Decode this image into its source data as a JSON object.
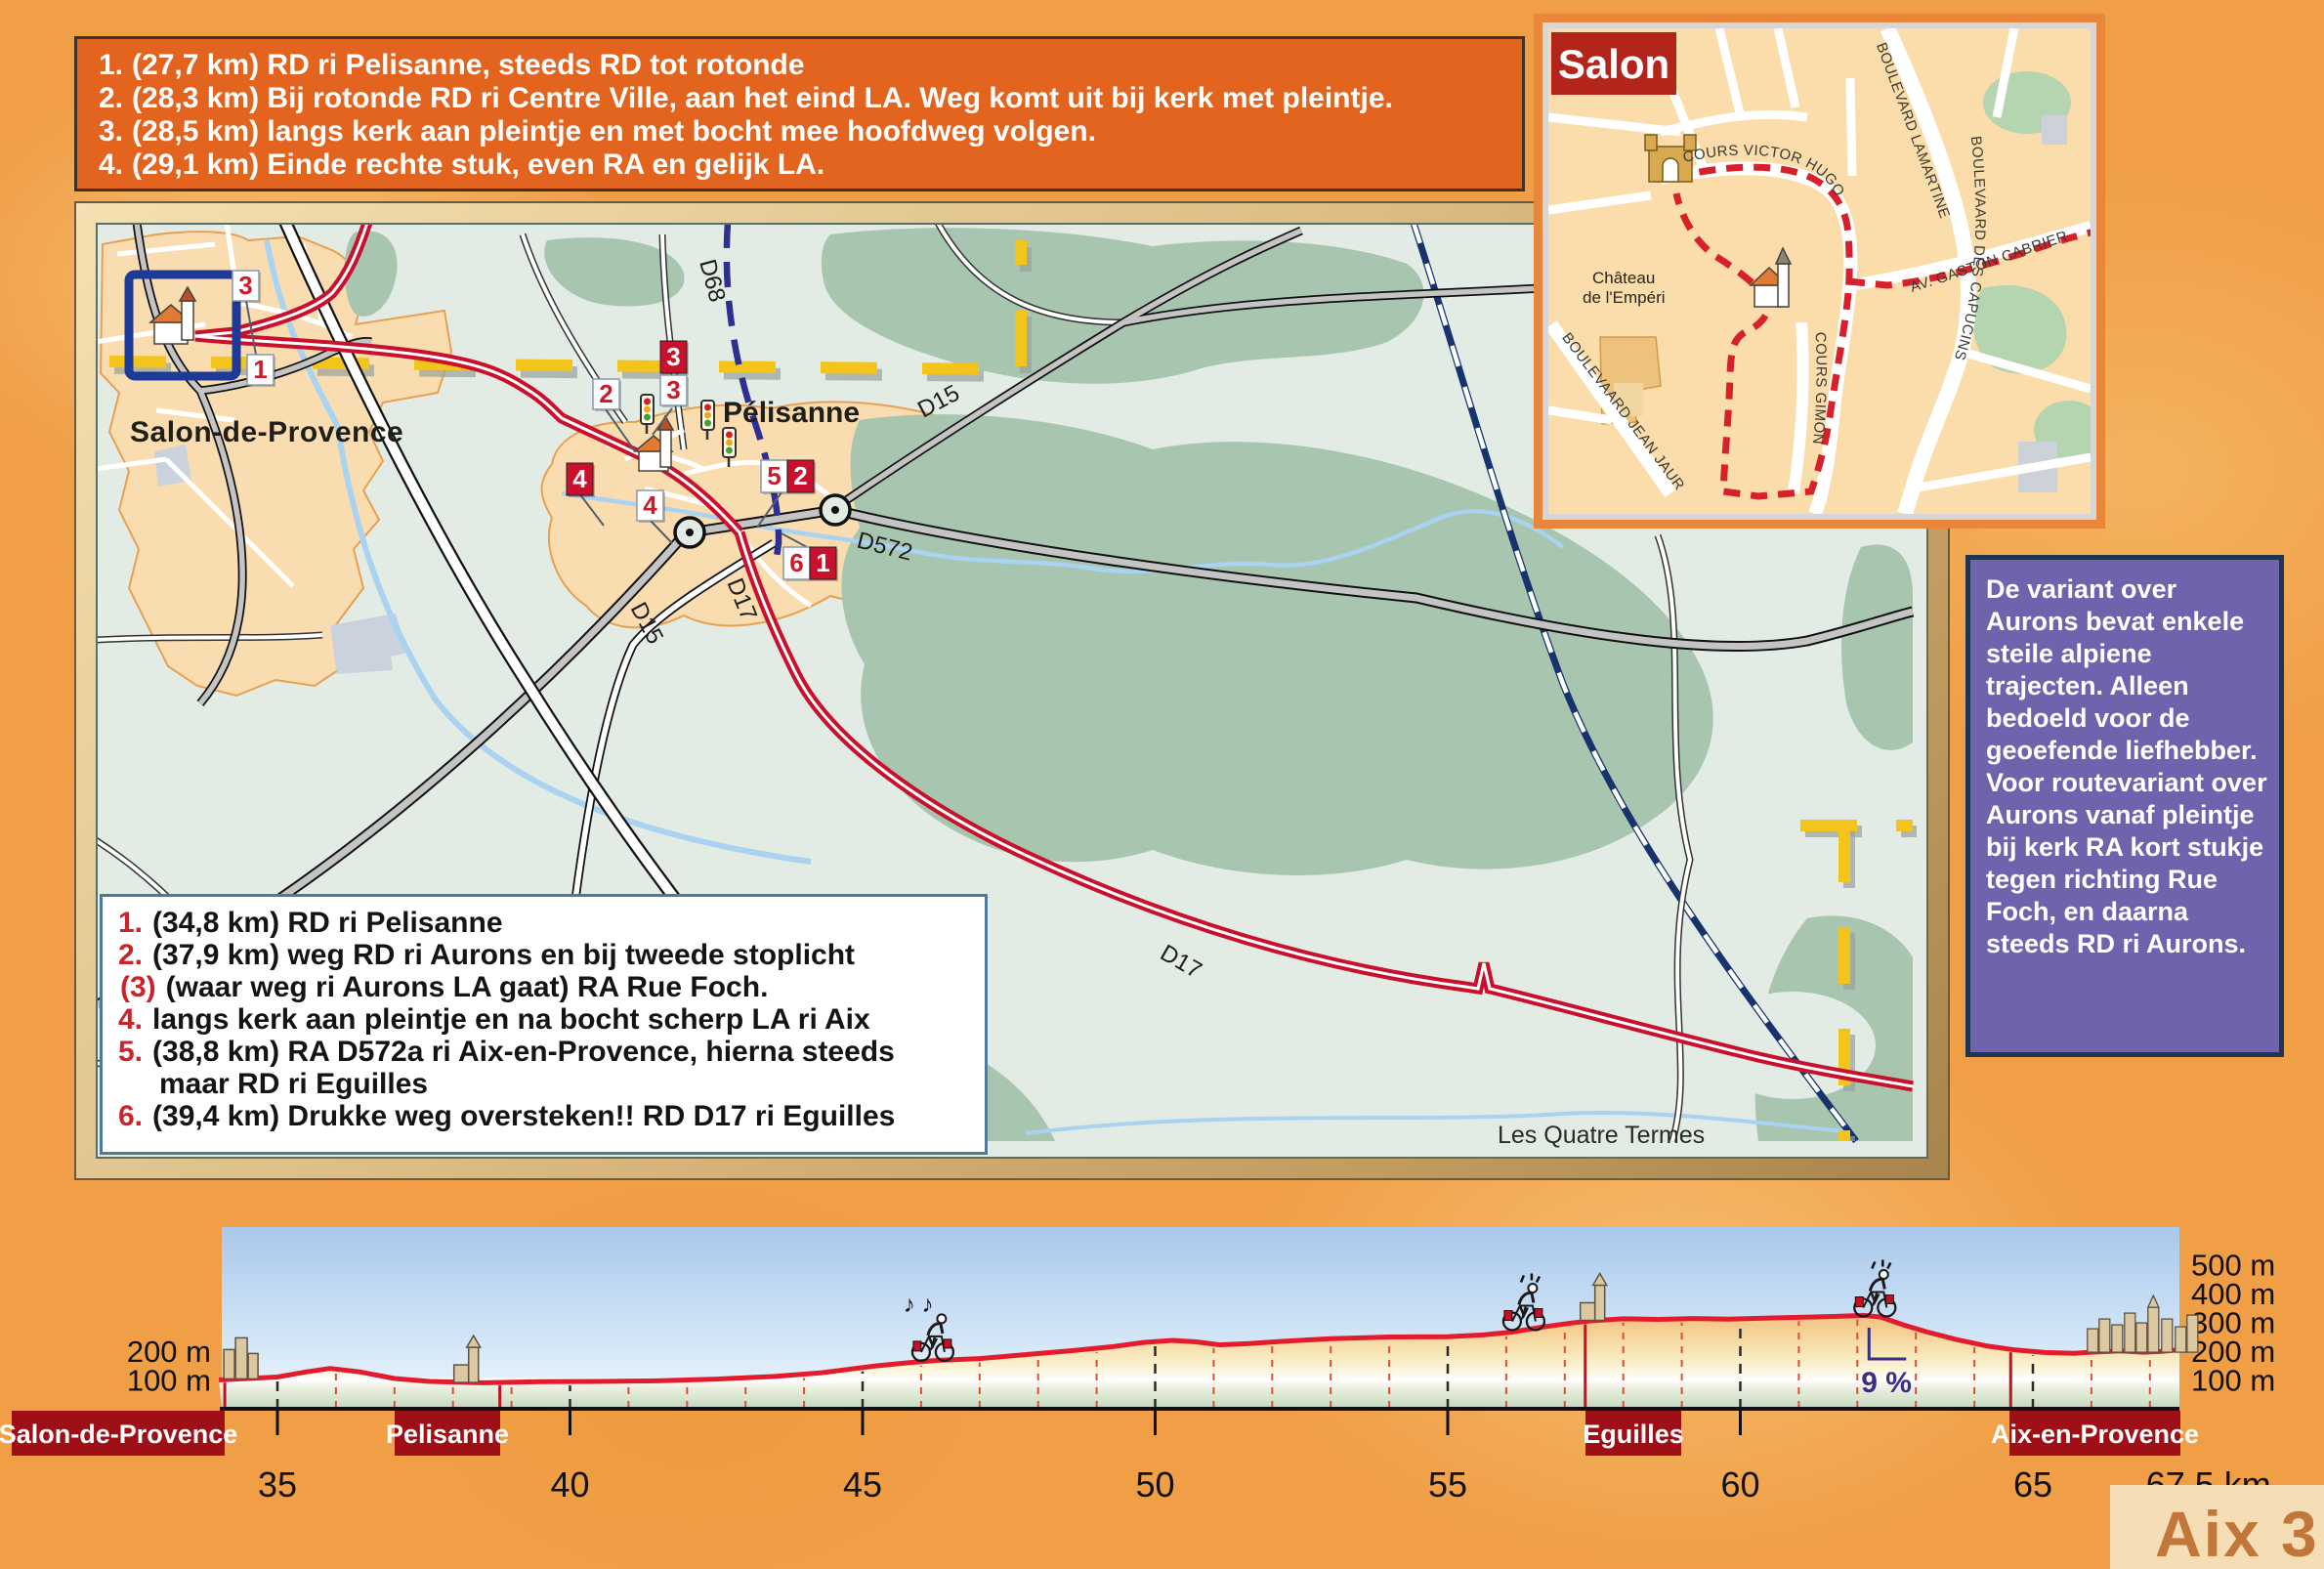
{
  "top_instructions": {
    "items": [
      {
        "num": "1.",
        "text": "(27,7 km) RD ri Pelisanne, steeds RD tot rotonde"
      },
      {
        "num": "2.",
        "text": "(28,3 km) Bij rotonde RD ri Centre Ville, aan het eind LA. Weg komt uit bij kerk met pleintje."
      },
      {
        "num": "3.",
        "text": "(28,5 km) langs kerk aan pleintje en met bocht mee hoofdweg volgen."
      },
      {
        "num": "4.",
        "text": "(29,1 km) Einde rechte stuk, even RA en gelijk LA."
      }
    ]
  },
  "bottom_instructions": {
    "items": [
      {
        "num": "1.",
        "text": "(34,8 km) RD ri Pelisanne"
      },
      {
        "num": "2.",
        "text": "(37,9 km) weg RD ri Aurons en bij tweede stoplicht"
      },
      {
        "num": "(3)",
        "text": "(waar weg ri Aurons LA gaat) RA Rue Foch."
      },
      {
        "num": "4.",
        "text": "langs kerk aan pleintje en na bocht scherp LA ri Aix"
      },
      {
        "num": "5.",
        "text": "(38,8 km) RA D572a ri Aix-en-Provence, hierna steeds maar RD ri Eguilles"
      },
      {
        "num": "6.",
        "text": "(39,4 km) Drukke weg oversteken!! RD D17 ri Eguilles"
      }
    ]
  },
  "variant_note": {
    "text": "De variant over Aurons bevat enkele steile alpiene trajecten. Alleen bedoeld voor de geoefende liefhebber. Voor routevariant over Aurons vanaf pleintje bij kerk RA kort stukje tegen richting Rue Foch, en daarna steeds RD ri Aurons."
  },
  "map": {
    "towns": {
      "salon": "Salon-de-Provence",
      "pelisanne": "Pélisanne"
    },
    "place": "Les Quatre Termes",
    "roads": {
      "d68": "D68",
      "d15": "D15",
      "d572": "D572",
      "d17": "D17"
    },
    "markers": [
      {
        "id": "salon-3",
        "label": "3",
        "style": "white"
      },
      {
        "id": "salon-1",
        "label": "1",
        "style": "white"
      },
      {
        "id": "pel-2",
        "label": "2",
        "style": "white"
      },
      {
        "id": "pel-3-red",
        "label": "3",
        "style": "red"
      },
      {
        "id": "pel-3-white",
        "label": "3",
        "style": "white"
      },
      {
        "id": "pel-4-red",
        "label": "4",
        "style": "red"
      },
      {
        "id": "pel-4-white",
        "label": "4",
        "style": "white"
      },
      {
        "id": "pel-5",
        "label": "5",
        "style": "white"
      },
      {
        "id": "pel-2-red",
        "label": "2",
        "style": "red"
      },
      {
        "id": "pel-6",
        "label": "6",
        "style": "white"
      },
      {
        "id": "pel-1-red",
        "label": "1",
        "style": "red"
      }
    ]
  },
  "inset": {
    "title": "Salon",
    "chateau_line1": "Château",
    "chateau_line2": "de l'Empéri",
    "streets": {
      "victor": "COURS VICTOR HUGO",
      "lamartine": "BOULEVARD LAMARTINE",
      "capucins": "BOULEVAARD DES CAPUCINS",
      "gaston": "AV. GASTON CABRIER",
      "gimon": "COURS GIMON",
      "jaures": "BOULEVAARD JEAN JAURÈS"
    }
  },
  "page_label": "Aix 3",
  "chart_data": {
    "type": "area",
    "title": "Hoogteprofiel Salon-de-Provence - Aix-en-Provence",
    "xlabel": "km",
    "ylabel": "m",
    "x_range": [
      34,
      67.5
    ],
    "ylim": [
      0,
      500
    ],
    "x_ticks": [
      35,
      40,
      45,
      50,
      55,
      60,
      65
    ],
    "x_end_label": "67,5 km",
    "y_ticks_left": [
      {
        "label": "200 m",
        "m": 200
      },
      {
        "label": "100 m",
        "m": 100
      }
    ],
    "y_ticks_right": [
      {
        "label": "500 m",
        "m": 500
      },
      {
        "label": "400 m",
        "m": 400
      },
      {
        "label": "300 m",
        "m": 300
      },
      {
        "label": "200 m",
        "m": 200
      },
      {
        "label": "100 m",
        "m": 100
      }
    ],
    "series": {
      "name": "elevation_m",
      "points": [
        [
          34,
          100
        ],
        [
          35,
          110
        ],
        [
          35.5,
          128
        ],
        [
          35.9,
          140
        ],
        [
          36.4,
          128
        ],
        [
          37,
          105
        ],
        [
          37.6,
          95
        ],
        [
          38.5,
          90
        ],
        [
          39.5,
          94
        ],
        [
          40.5,
          95
        ],
        [
          41.5,
          97
        ],
        [
          42.5,
          103
        ],
        [
          43.5,
          112
        ],
        [
          44.3,
          125
        ],
        [
          44.8,
          138
        ],
        [
          45.2,
          148
        ],
        [
          45.8,
          160
        ],
        [
          46.3,
          168
        ],
        [
          47,
          174
        ],
        [
          47.8,
          188
        ],
        [
          48.6,
          202
        ],
        [
          49.3,
          216
        ],
        [
          49.8,
          230
        ],
        [
          50.3,
          237
        ],
        [
          50.7,
          232
        ],
        [
          51.1,
          222
        ],
        [
          51.6,
          226
        ],
        [
          52.2,
          234
        ],
        [
          53,
          243
        ],
        [
          54,
          249
        ],
        [
          55,
          250
        ],
        [
          55.6,
          256
        ],
        [
          56.1,
          266
        ],
        [
          56.6,
          283
        ],
        [
          57.1,
          297
        ],
        [
          57.5,
          306
        ],
        [
          58,
          312
        ],
        [
          58.6,
          310
        ],
        [
          59.2,
          313
        ],
        [
          59.8,
          311
        ],
        [
          60.4,
          314
        ],
        [
          61,
          317
        ],
        [
          61.6,
          320
        ],
        [
          62.1,
          324
        ],
        [
          62.4,
          318
        ],
        [
          62.8,
          290
        ],
        [
          63.2,
          266
        ],
        [
          63.7,
          240
        ],
        [
          64.2,
          218
        ],
        [
          64.7,
          204
        ],
        [
          65.2,
          195
        ],
        [
          65.7,
          192
        ],
        [
          66.1,
          197
        ],
        [
          66.5,
          201
        ],
        [
          66.9,
          196
        ],
        [
          67.2,
          199
        ],
        [
          67.5,
          205
        ]
      ]
    },
    "towns": [
      {
        "name": "Salon-de-Provence",
        "km": 34.1,
        "box": [
          12,
          230
        ]
      },
      {
        "name": "Pelisanne",
        "km": 38.8,
        "box": [
          404,
          512
        ]
      },
      {
        "name": "Eguilles",
        "km": 57.35,
        "box": [
          1623,
          1721
        ]
      },
      {
        "name": "Aix-en-Provence",
        "km": 64.62,
        "box": [
          2057,
          2232
        ]
      }
    ],
    "annotations": [
      {
        "label": "9 %",
        "km": 62.2
      }
    ],
    "decorations": [
      {
        "type": "city",
        "km": 34.35,
        "label": ""
      },
      {
        "type": "church",
        "km": 38.3,
        "label": ""
      },
      {
        "type": "cyclist",
        "km": 46.2,
        "flavor": "music",
        "label": "♪ ♪"
      },
      {
        "type": "cyclist",
        "km": 56.3,
        "flavor": "exclaim",
        "label": ""
      },
      {
        "type": "church",
        "km": 57.55,
        "label": ""
      },
      {
        "type": "cyclist",
        "km": 62.3,
        "flavor": "exclaim",
        "label": ""
      },
      {
        "type": "city-large",
        "km": 66.9,
        "label": ""
      }
    ],
    "grid": {
      "major_dashed_black": true,
      "minor_dashed_red_every_km": true,
      "white_line_at_m": 100
    }
  }
}
